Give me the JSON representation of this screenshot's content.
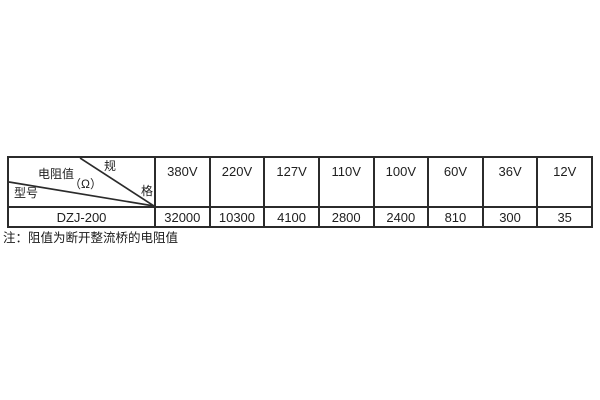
{
  "page": {
    "background": "#ffffff",
    "border_color": "#2b2b2b",
    "text_color": "#1e1e1e"
  },
  "table": {
    "corner": {
      "spec_char_top": "规",
      "spec_char_bottom": "格",
      "value_label": "电阻值",
      "value_unit": "（Ω）",
      "model_label": "型号"
    },
    "voltage_columns": [
      "380V",
      "220V",
      "127V",
      "110V",
      "100V",
      "60V",
      "36V",
      "12V"
    ],
    "rows": [
      {
        "model": "DZJ-200",
        "values": [
          "32000",
          "10300",
          "4100",
          "2800",
          "2400",
          "810",
          "300",
          "35"
        ]
      }
    ]
  },
  "note": {
    "text": "注：阻值为断开整流桥的电阻值"
  }
}
